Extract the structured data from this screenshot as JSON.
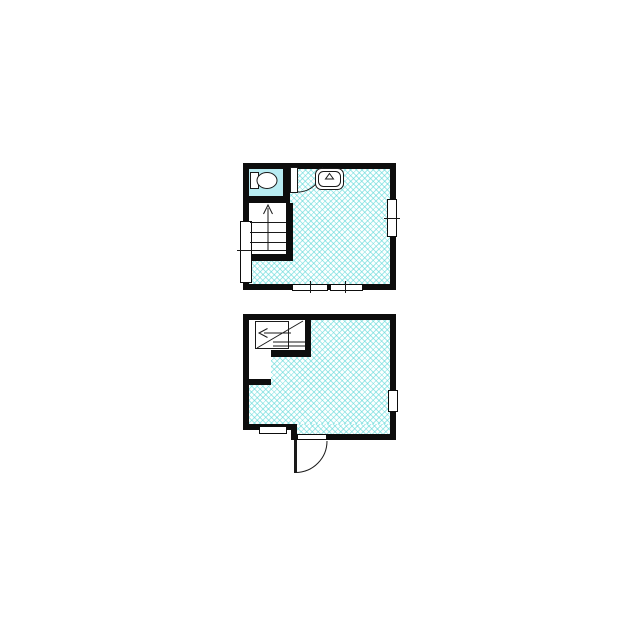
{
  "canvas": {
    "width": 640,
    "height": 640,
    "background": "#ffffff"
  },
  "colors": {
    "wall": "#0d0d0d",
    "line": "#1a1a1a",
    "hatch_line": "#5ad7d7",
    "hatch_bg": "#fdffff",
    "wc_fill": "#b8ecf2",
    "fixture_fill": "#ffffff",
    "background": "#ffffff"
  },
  "plans": [
    {
      "name": "upper-floor",
      "label": "Upper floor plan with toilet room, sink, staircase going up and windows",
      "rooms": [
        {
          "name": "wc",
          "label": "Toilet room with cyan floor and toilet fixture"
        },
        {
          "name": "main-room",
          "label": "Main room with crosshatched flooring"
        }
      ],
      "fixtures": [
        {
          "name": "toilet",
          "label": "Toilet with tank and bowl"
        },
        {
          "name": "sink",
          "label": "Wall-mounted sink with faucet mark"
        },
        {
          "name": "staircase-up",
          "label": "Staircase with up arrow and treads"
        },
        {
          "name": "wc-door",
          "label": "Toilet door with quarter-circle swing arc"
        }
      ],
      "windows": [
        {
          "name": "left-wall-window",
          "label": "Tall window on left wall with center tick"
        },
        {
          "name": "right-wall-window",
          "label": "Window on right wall with center tick"
        },
        {
          "name": "bottom-wall-window-1",
          "label": "Left window on bottom wall"
        },
        {
          "name": "bottom-wall-window-2",
          "label": "Right window on bottom wall"
        }
      ]
    },
    {
      "name": "lower-floor",
      "label": "Lower floor plan with winder staircase, entrance door and windows",
      "rooms": [
        {
          "name": "stair-hall",
          "label": "Stair enclosure with landing and under-stair closet"
        },
        {
          "name": "main-room",
          "label": "Main room with crosshatched flooring"
        }
      ],
      "fixtures": [
        {
          "name": "staircase-down",
          "label": "Winder staircase with left arrow, diagonal break line and treads"
        },
        {
          "name": "entrance-door",
          "label": "Entrance door swinging outward with quarter-circle arc"
        }
      ],
      "windows": [
        {
          "name": "right-wall-window",
          "label": "Small window on right wall"
        },
        {
          "name": "bottom-left-window",
          "label": "Small window on bottom-left wall"
        }
      ]
    }
  ]
}
